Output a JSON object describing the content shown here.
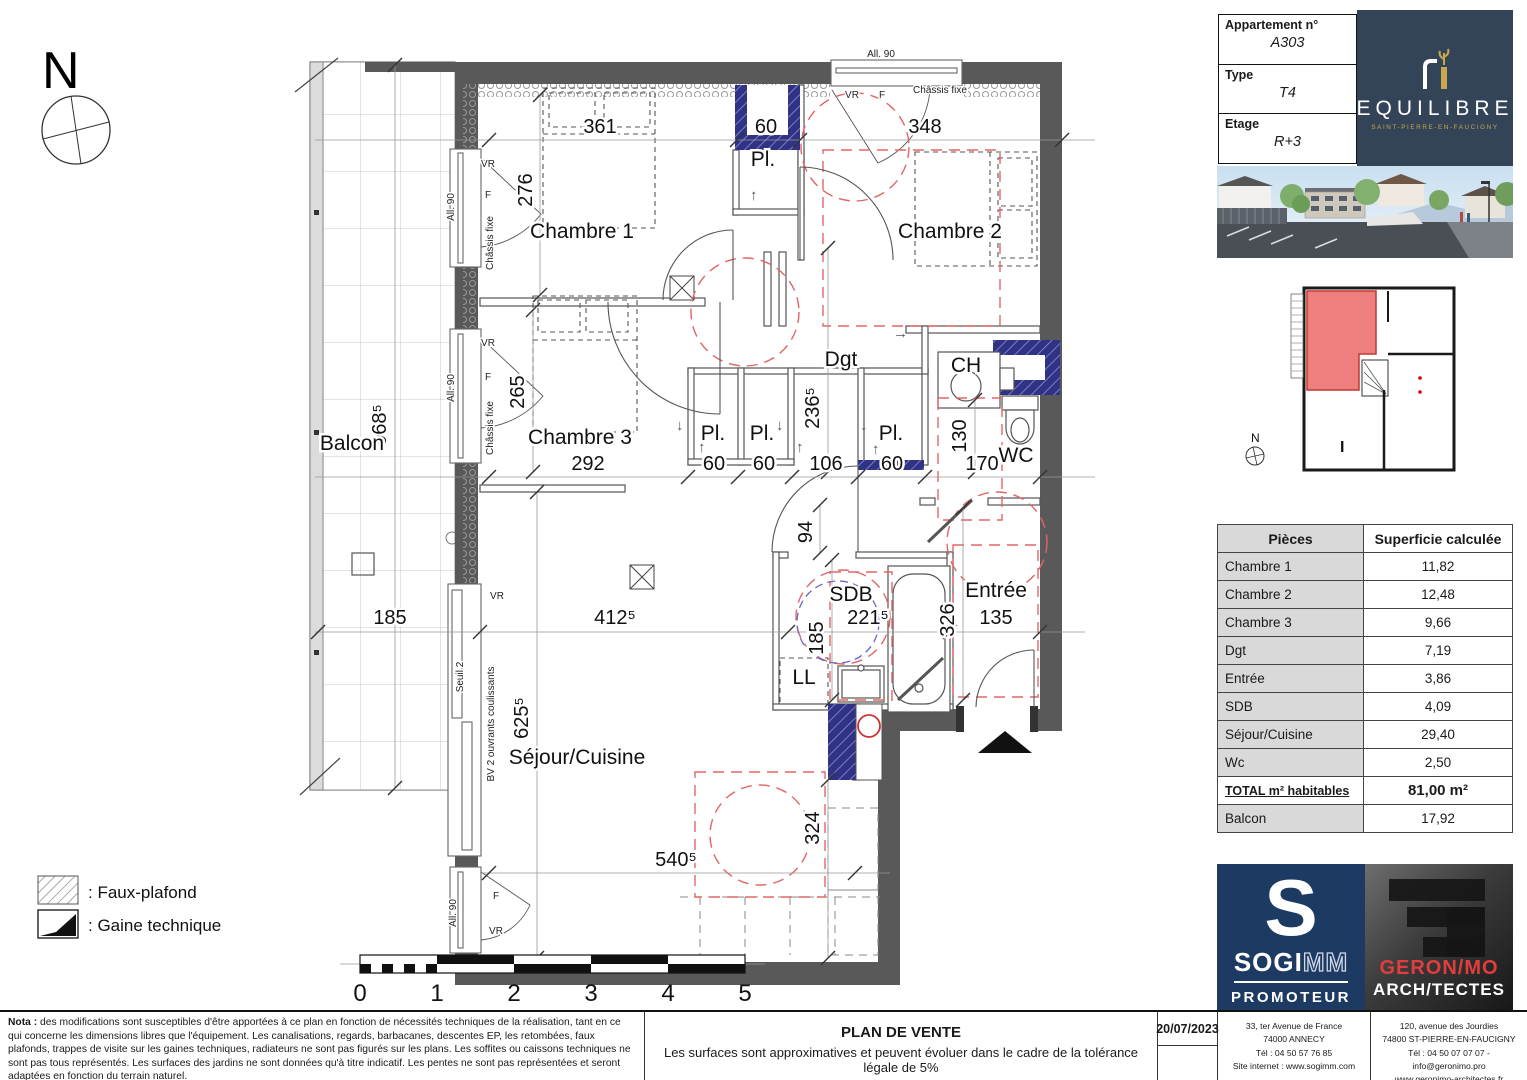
{
  "header": {
    "apartment_label": "Appartement n°",
    "apartment_value": "A303",
    "type_label": "Type",
    "type_value": "T4",
    "floor_label": "Etage",
    "floor_value": "R+3",
    "brand_name": "EQUILIBRE",
    "brand_city": "SAINT-PIERRE-EN-FAUCIGNY"
  },
  "plan": {
    "compass_n": "N",
    "rooms": {
      "balcon": "Balcon",
      "chambre1": "Chambre 1",
      "chambre2": "Chambre 2",
      "chambre3": "Chambre 3",
      "dgt": "Dgt",
      "sejour_cuisine": "Séjour/Cuisine",
      "sdb": "SDB",
      "entree": "Entrée",
      "wc": "WC",
      "ch": "CH",
      "ll": "LL",
      "pl": "Pl."
    },
    "dims": {
      "ch1_w": "361",
      "ch1_h": "276",
      "pl_top": "60",
      "ch2_w": "348",
      "ch3_h": "265",
      "ch3_w": "292",
      "pl_a": "60",
      "pl_b": "60",
      "hall": "106",
      "pl_c": "60",
      "dgt_h": "236⁵",
      "wc_w": "130",
      "wc_len": "170",
      "sdb_door": "94",
      "sdb_h": "185",
      "sdb_w": "221⁵",
      "entree_h": "326",
      "entree_w": "135",
      "sejour_w": "412⁵",
      "sejour_h": "625⁵",
      "sejour_w2": "540⁵",
      "kitchen_h": "324",
      "balcon_h": "968⁵",
      "balcon_w": "185"
    },
    "windows": {
      "all90": "All. 90",
      "vr": "VR",
      "f": "F",
      "chassis_fixe": "Châssis fixe",
      "bv": "BV  2 ouvrants coulissants",
      "seuil": "Seuil 2"
    },
    "scale_labels": [
      "0",
      "1",
      "2",
      "3",
      "4",
      "5"
    ]
  },
  "legend": {
    "faux_plafond": ": Faux-plafond",
    "gaine": ": Gaine technique"
  },
  "key_plan": {
    "north": "N",
    "unit_label": "I"
  },
  "areas_table": {
    "col_pieces": "Pièces",
    "col_superficie": "Superficie calculée",
    "rows": [
      {
        "name": "Chambre 1",
        "value": "11,82"
      },
      {
        "name": "Chambre 2",
        "value": "12,48"
      },
      {
        "name": "Chambre 3",
        "value": "9,66"
      },
      {
        "name": "Dgt",
        "value": "7,19"
      },
      {
        "name": "Entrée",
        "value": "3,86"
      },
      {
        "name": "SDB",
        "value": "4,09"
      },
      {
        "name": "Séjour/Cuisine",
        "value": "29,40"
      },
      {
        "name": "Wc",
        "value": "2,50"
      }
    ],
    "total_label": "TOTAL m² habitables",
    "total_value": "81,00 m²",
    "balcon_label": "Balcon",
    "balcon_value": "17,92"
  },
  "logos": {
    "sogimm_s": "S",
    "sogimm_solid": "SOGI",
    "sogimm_outline": "MM",
    "sogimm_tag": "PROMOTEUR",
    "geronimo_name": "GERON/MO",
    "geronimo_tag": "ARCH/TECTES"
  },
  "footer": {
    "nota_label": "Nota :",
    "nota_text": " des modifications sont susceptibles d'être apportées à ce plan en fonction de nécessités techniques de la réalisation, tant en ce qui concerne les dimensions libres que l'équipement. Les canalisations, regards, barbacanes, descentes EP, les retombées, faux plafonds, trappes de visite sur les gaines techniques, radiateurs ne sont pas figurés sur les plans. Les soffites ou caissons techniques ne sont pas tous représentés. Les surfaces des jardins ne sont données qu'à titre indicatif. Les pentes ne sont pas représentées et seront adaptées en fonction du terrain naturel.",
    "title": "PLAN DE VENTE",
    "subtitle": "Les surfaces sont approximatives et peuvent évoluer dans le cadre de la tolérance légale de 5%",
    "date": "20/07/2023",
    "sogimm_lines": [
      "33, ter Avenue de France",
      "74000 ANNECY",
      "Tél : 04 50 57 76 85",
      "Site internet : www.sogimm.com"
    ],
    "geronimo_lines": [
      "120, avenue des Jourdies",
      "74800 ST-PIERRE-EN-FAUCIGNY",
      "Tél : 04 50 07 07 07 - info@geronimo.pro",
      "www.geronimo-architectes.fr"
    ]
  }
}
